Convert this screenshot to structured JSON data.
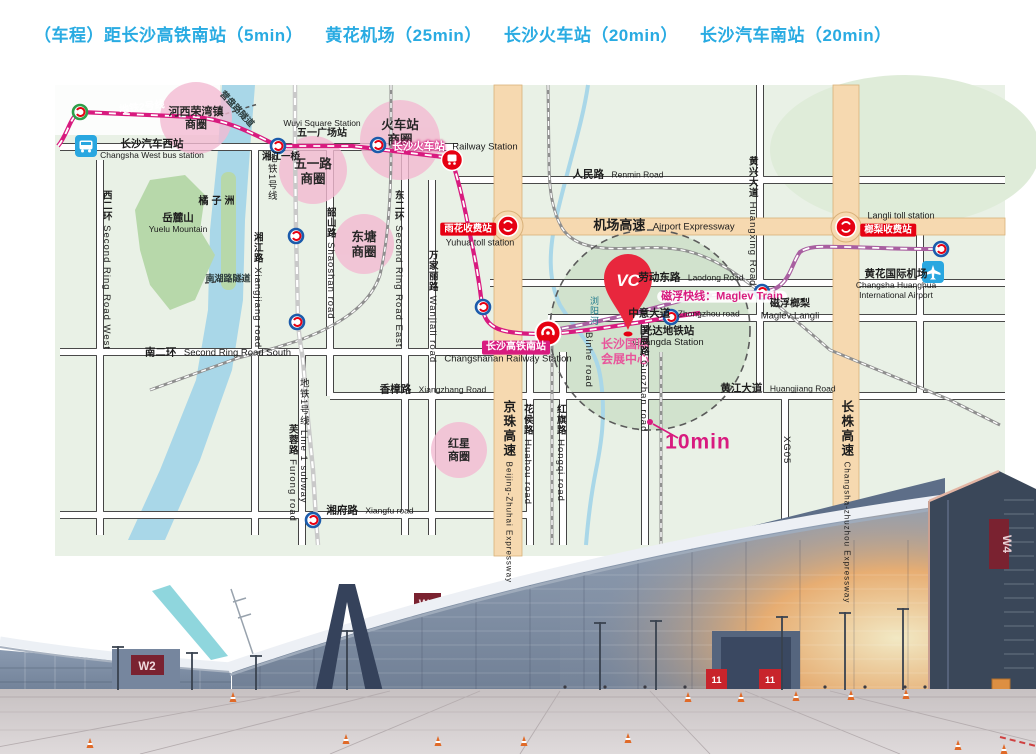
{
  "header": {
    "items": [
      "（车程）距长沙高铁南站（5min）",
      "黄花机场（25min）",
      "长沙火车站（20min）",
      "长沙汽车南站（20min）"
    ]
  },
  "colors": {
    "header_blue": "#29ABE2",
    "metro_line2": "#D81B7F",
    "maglev_purple": "#A85FA0",
    "district_pink": "#F3BAD2",
    "toll_red": "#E60012",
    "expressway_beige": "#F6D9B0",
    "river_blue": "#A9D7E8"
  },
  "map": {
    "metro2_label": "地铁2号线",
    "metro1_label": "地铁1号线",
    "line1_label": {
      "zh": "地铁1号线",
      "en": "Line 1 subway"
    },
    "maglev_label": "磁浮快线：Maglev Train",
    "tenmin": "10min",
    "districts": [
      {
        "l1": "河西荣湾镇",
        "l2": "商圈"
      },
      {
        "l1": "火车站",
        "l2": "商圈"
      },
      {
        "l1": "五一路",
        "l2": "商圈"
      },
      {
        "l1": "东塘",
        "l2": "商圈"
      },
      {
        "l1": "红星",
        "l2": "商圈"
      }
    ],
    "stations": {
      "west_bus": {
        "zh": "长沙汽车西站",
        "en": "Changsha West bus station"
      },
      "wuyi_square": {
        "en": "Wuyi Square Station",
        "zh": "五一广场站"
      },
      "xiangjiang_bridge": "湘江一桥",
      "railway_station": {
        "zh": "长沙火车站",
        "en": "Railway Station"
      },
      "south_station": {
        "zh": "长沙高铁南站",
        "en": "Changshanan Railway Station"
      },
      "guangda": {
        "zh": "光达地铁站",
        "en": "Guangda Station"
      },
      "maglev_langli": {
        "zh": "磁浮榔梨",
        "en": "Maglev Langli"
      },
      "airport": {
        "zh": "黄花国际机场",
        "en1": "Changsha Huanghua",
        "en2": "International Airport"
      },
      "yuhua_toll": {
        "zh": "雨花收费站",
        "en": "Yuhua toll station"
      },
      "langli_toll": {
        "zh": "榔梨收费站",
        "en": "Langli toll station"
      },
      "convention": {
        "l1": "长沙国际",
        "l2": "会展中心"
      }
    },
    "roads": {
      "renmin": {
        "zh": "人民路",
        "en": "Renmin Road"
      },
      "laodong": {
        "zh": "劳动东路",
        "en": "Laodong Road"
      },
      "zhongzhou": {
        "zh": "中意大道",
        "en": "Zhongzhou road"
      },
      "airport_expwy": {
        "zh": "机场高速",
        "en": "Airport Expressway"
      },
      "second_ring_west": {
        "zh": "西二环",
        "en": "Second Ring Road West"
      },
      "second_ring_east": {
        "zh": "东二环",
        "en": "Second Ring Road East"
      },
      "second_ring_south": {
        "zh": "南二环",
        "en": "Second Ring Road South"
      },
      "xiangjiang_rd": {
        "zh": "湘江路",
        "en": "Xiangjiang road"
      },
      "shaoshan": {
        "zh": "韶山路",
        "en": "Shaoshan road"
      },
      "wanjiali": {
        "zh": "万家丽路",
        "en": "Wanjiali road"
      },
      "furong": {
        "zh": "芙蓉路",
        "en": "Furong road"
      },
      "xiangzhang": {
        "zh": "香樟路",
        "en": "Xiangzhang Road"
      },
      "xiangfu": {
        "zh": "湘府路",
        "en": "Xiangfu road"
      },
      "jingzhu": {
        "zh": "京珠高速",
        "en": "Beijing-Zhuhai Expressway"
      },
      "huahou": {
        "zh": "花侯路",
        "en": "Huahou road"
      },
      "hongqi": {
        "zh": "红旗路",
        "en": "Hongqi road"
      },
      "guozhan": {
        "zh": "国展路",
        "en": "Guozhan road"
      },
      "huangjiang": {
        "zh": "黄江大道",
        "en": "Huangjiang Road"
      },
      "huangxing": {
        "zh": "黄兴大道",
        "en": "Huangxing Road"
      },
      "xg05": "XG05",
      "changzhu": {
        "zh": "长株高速",
        "en": "Changsha-zhuzhou Expressway"
      },
      "binhe": "Binhe road"
    },
    "places": {
      "yuelu": {
        "zh": "岳麓山",
        "en": "Yuelu Mountain"
      },
      "juzizhou": "橘子洲",
      "liuyang_river": "浏阳河",
      "yingpan_tunnel": "营盘路隧道",
      "nanhu_tunnel": "南湖路隧道",
      "pin_logo": "VC"
    }
  },
  "photo": {
    "w2_sign": "W2",
    "w4_sign": "W4",
    "w4_side_sign": "W4",
    "banner1": "11",
    "banner2": "11"
  }
}
